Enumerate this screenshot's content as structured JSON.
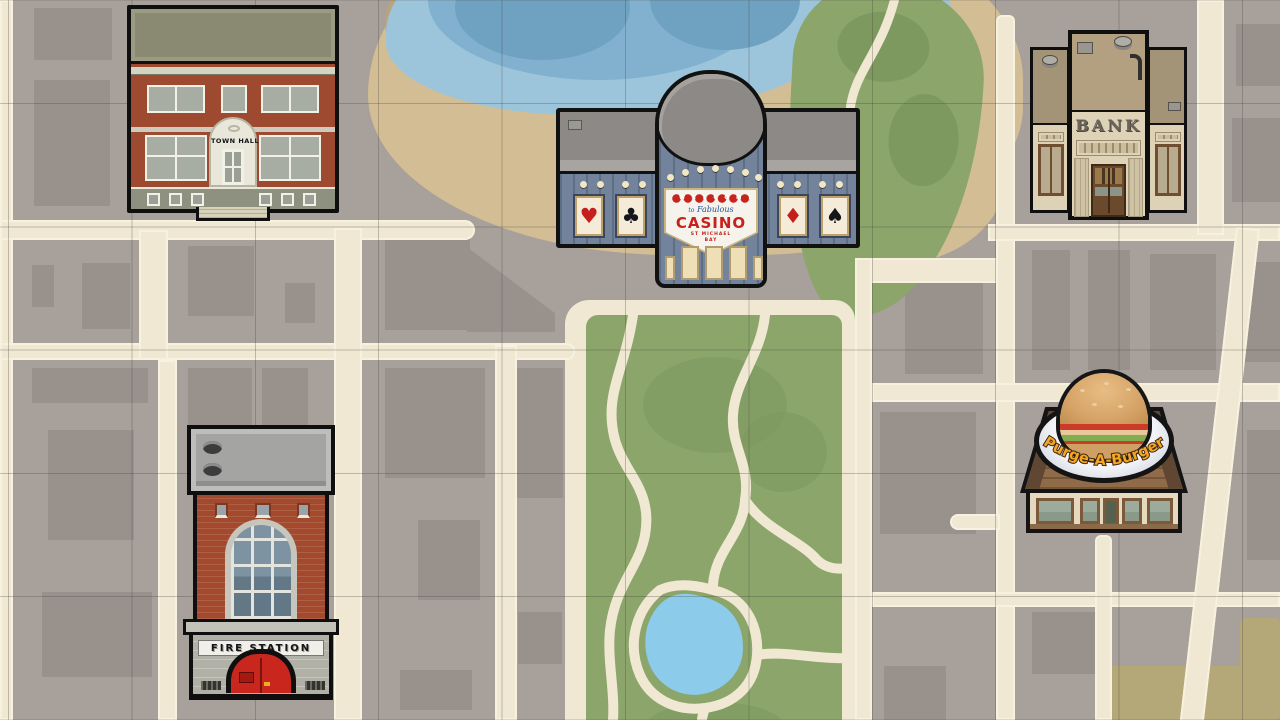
{
  "buildings": {
    "town_hall": {
      "label": "Town Hall",
      "sign": "TOWN HALL"
    },
    "casino": {
      "label": "Casino",
      "welcome": "WELCOME",
      "to": "to",
      "fabulous": "Fabulous",
      "name": "CASINO",
      "sub1": "ST MICHAEL",
      "sub2": "BAY",
      "cards": {
        "heart": "♥",
        "club": "♣",
        "diamond": "♦",
        "spade": "♠"
      }
    },
    "bank": {
      "label": "Bank",
      "sign": "BANK"
    },
    "fire_station": {
      "label": "Fire Station",
      "sign": "FIRE STATION"
    },
    "burger": {
      "label": "Purge-A-Burger",
      "sign": "Purge-A-Burger"
    }
  },
  "terrain": {
    "colors": {
      "block_gray": "#a7a09b",
      "footprint_gray": "#99918c",
      "street_cream": "#f0e8d2",
      "sand": "#d2bd95",
      "water_light": "#9cc5db",
      "water_mid": "#81b1cf",
      "water_dark": "#6fa1c1",
      "park_green": "#8ba56a",
      "park_green_dark": "#7e9960",
      "pond_blue": "#8ccbe9",
      "khaki_block": "#b5a878"
    }
  }
}
